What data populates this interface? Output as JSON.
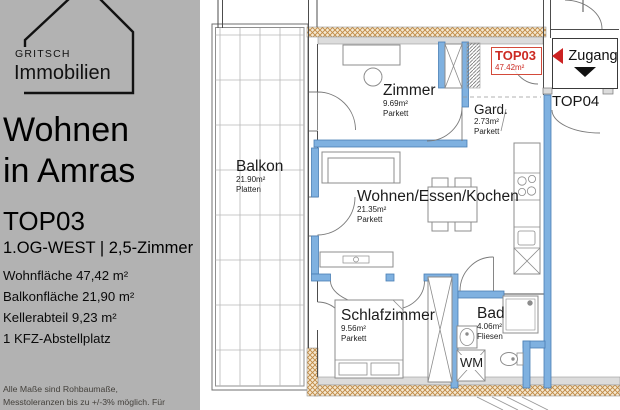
{
  "sidebar": {
    "brand": {
      "top": "GRITSCH",
      "bottom": "Immobilien"
    },
    "title": [
      "Wohnen",
      "in Amras"
    ],
    "unit": "TOP03",
    "unit_subtitle": "1.OG-WEST | 2,5-Zimmer",
    "facts": [
      "Wohnfläche 47,42 m²",
      "Balkonfläche 21,90 m²",
      "Kellerabteil 9,23 m²",
      "1 KFZ-Abstellplatz"
    ],
    "disclaimer": "Alle Maße sind Rohbaumaße, Messtoleranzen bis zu +/-3% möglich. Für die Möblierung Naturmaße"
  },
  "plan": {
    "unit_tag": {
      "name": "TOP03",
      "area": "47.42m²"
    },
    "entrance_label": "Zugang",
    "neighbor_unit": "TOP04",
    "washer_label": "WM",
    "rooms": [
      {
        "id": "balkon",
        "name": "Balkon",
        "area": "21.90m²",
        "floor": "Platten"
      },
      {
        "id": "zimmer",
        "name": "Zimmer",
        "area": "9.69m²",
        "floor": "Parkett"
      },
      {
        "id": "gard",
        "name": "Gard.",
        "area": "2.73m²",
        "floor": "Parkett"
      },
      {
        "id": "wohnen",
        "name": "Wohnen/Essen/Kochen",
        "area": "21.35m²",
        "floor": "Parkett"
      },
      {
        "id": "schlafzimmer",
        "name": "Schlafzimmer",
        "area": "9.56m²",
        "floor": "Parkett"
      },
      {
        "id": "bad",
        "name": "Bad",
        "area": "4.06m²",
        "floor": "Fliesen"
      }
    ],
    "colors": {
      "sidebar_bg": "#b2b2b2",
      "wall_blue": "#7fb1e0",
      "wall_blue_edge": "#4a7fb5",
      "accent_red": "#cc2222",
      "hatch_tan": "#c08a45",
      "wall_gray": "#dcdcdc",
      "line": "#4d4d4d"
    }
  }
}
